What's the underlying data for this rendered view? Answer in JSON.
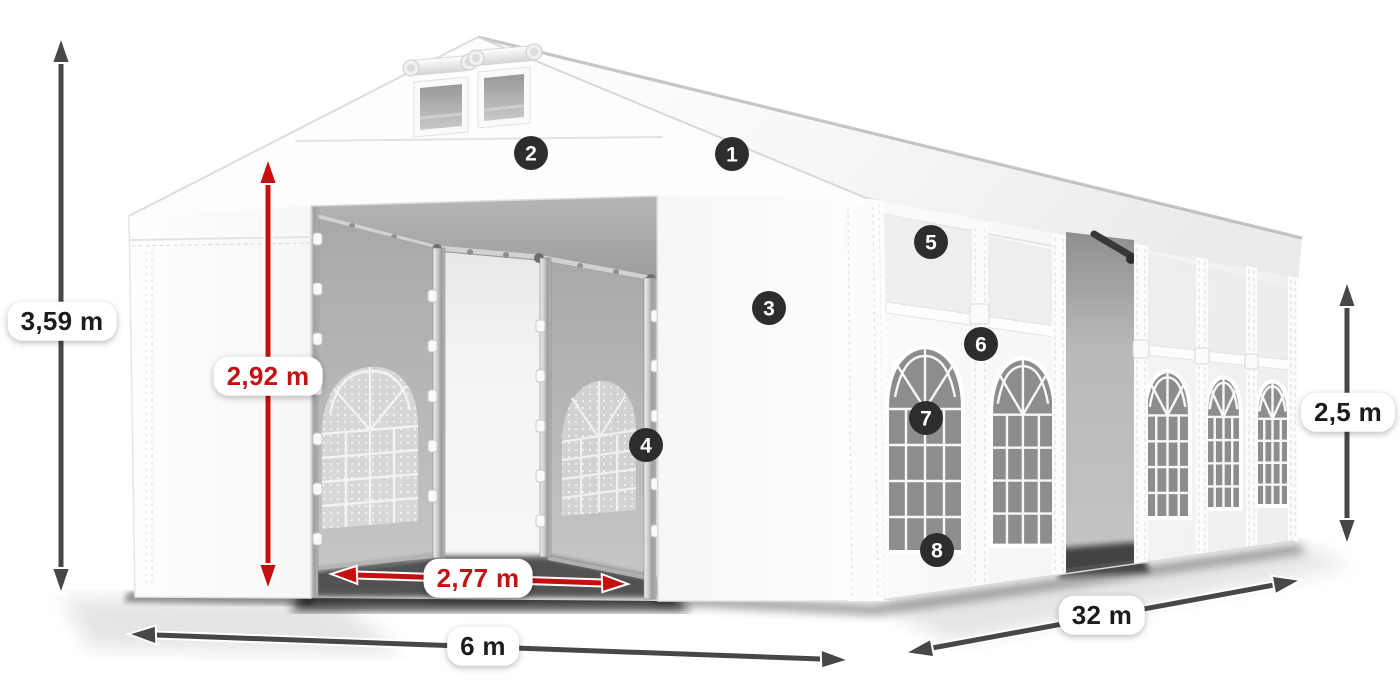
{
  "canvas": {
    "width": 1400,
    "height": 700,
    "background": "#ffffff"
  },
  "diagram": {
    "subject": "party-tent-dimension-diagram",
    "dimensions": {
      "total_height": {
        "label": "3,59 m",
        "style": "dark"
      },
      "entrance_height": {
        "label": "2,92 m",
        "style": "red"
      },
      "entrance_width": {
        "label": "2,77 m",
        "style": "red"
      },
      "gable_width": {
        "label": "6 m",
        "style": "dark"
      },
      "side_length": {
        "label": "32 m",
        "style": "dark"
      },
      "side_height": {
        "label": "2,5 m",
        "style": "dark"
      }
    },
    "markers": [
      {
        "number": "1"
      },
      {
        "number": "2"
      },
      {
        "number": "3"
      },
      {
        "number": "4"
      },
      {
        "number": "5"
      },
      {
        "number": "6"
      },
      {
        "number": "7"
      },
      {
        "number": "8"
      }
    ],
    "colors": {
      "dimension_red": "#c51111",
      "dimension_dark": "#474747",
      "marker_bg": "#2d2d2d",
      "marker_text": "#ffffff",
      "label_bg": "#ffffff",
      "label_text_dark": "#1c1c1c"
    }
  }
}
